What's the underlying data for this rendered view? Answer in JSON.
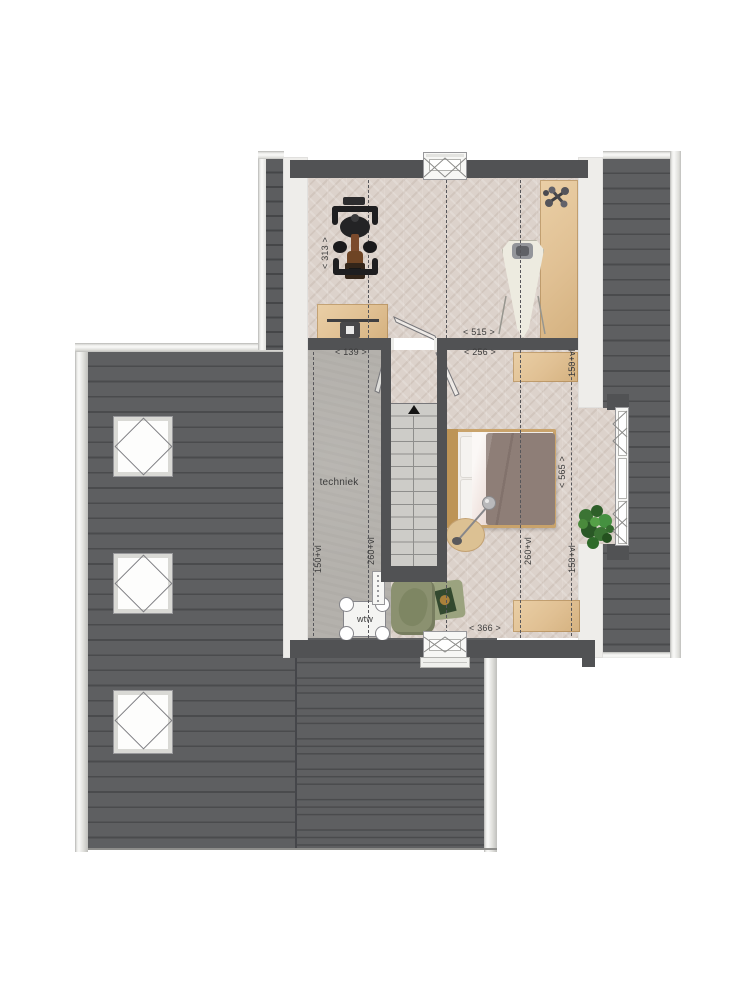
{
  "plan": {
    "room_label": "techniek",
    "wtw_label": "wtw",
    "stairs_direction_icon": "up-arrow",
    "dims": {
      "d313": "< 313 >",
      "d515": "< 515 >",
      "d139": "< 139 >",
      "d256": "< 256 >",
      "d366": "< 366 >",
      "d565": "< 565 >",
      "vl150_a": "150+vl",
      "vl150_b": "150+vl",
      "vl150_c": "150+vl",
      "vl260_a": "260+vl",
      "vl260_b": "260+vl"
    },
    "colors": {
      "roof": "#5e5f61",
      "roof_line": "#4a4b4d",
      "roof_edge": "#e2e2df",
      "wall": "#515254",
      "eave": "#eeedea",
      "floor_herringbone": "#dcd2cb",
      "floor_concrete": "#b4b1ac",
      "stair": "#cdccc8",
      "wood": "#e3c59b",
      "bed_blanket": "#8e7e77",
      "chair_green": "#8b9170",
      "rug_green": "#9ba37f",
      "plant_green": "#3f7d33"
    }
  }
}
